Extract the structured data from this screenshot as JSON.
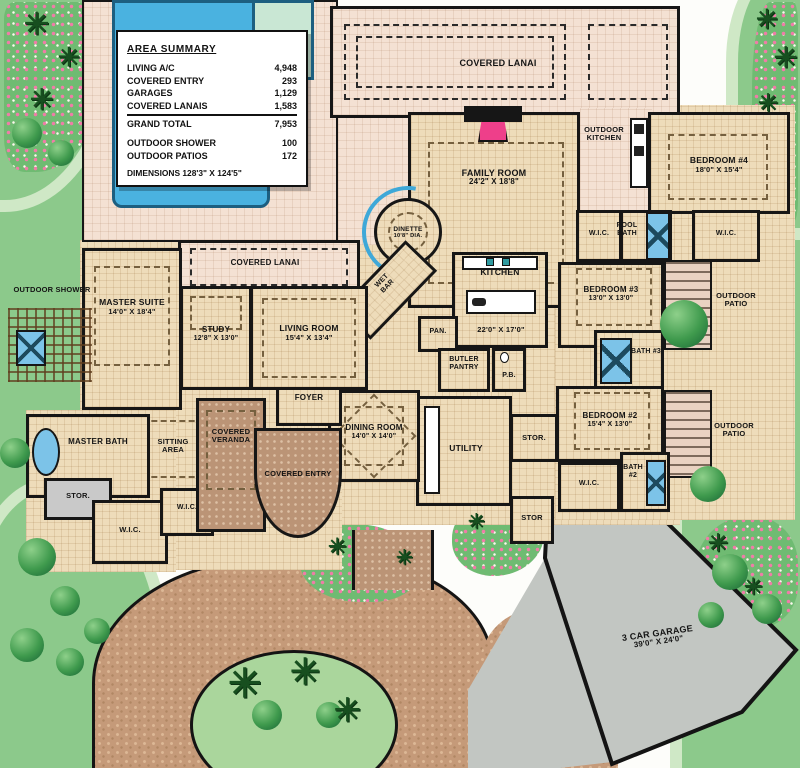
{
  "area_summary": {
    "title": "AREA SUMMARY",
    "rows": [
      {
        "label": "LIVING A/C",
        "value": "4,948"
      },
      {
        "label": "COVERED ENTRY",
        "value": "293"
      },
      {
        "label": "GARAGES",
        "value": "1,129"
      },
      {
        "label": "COVERED LANAIS",
        "value": "1,583"
      }
    ],
    "grand_total": {
      "label": "GRAND TOTAL",
      "value": "7,953"
    },
    "extras": [
      {
        "label": "OUTDOOR SHOWER",
        "value": "100"
      },
      {
        "label": "OUTDOOR PATIOS",
        "value": "172"
      }
    ],
    "dimensions": "DIMENSIONS 128'3\" X 124'5\""
  },
  "rooms": {
    "family_room": {
      "name": "FAMILY ROOM",
      "dims": "24'2\" X 18'8\""
    },
    "dinette": {
      "name": "DINETTE",
      "dims": "10'8\" DIA."
    },
    "kitchen": {
      "name": "KITCHEN",
      "dims": "22'0\" X 17'0\""
    },
    "living_room": {
      "name": "LIVING ROOM",
      "dims": "15'4\" X 13'4\""
    },
    "study": {
      "name": "STUDY",
      "dims": "12'8\" X 13'0\""
    },
    "master_suite": {
      "name": "MASTER SUITE",
      "dims": "14'0\" X 18'4\""
    },
    "dining_room": {
      "name": "DINING ROOM",
      "dims": "14'0\" X 14'0\""
    },
    "bedroom2": {
      "name": "BEDROOM #2",
      "dims": "15'4\" X 13'0\""
    },
    "bedroom3": {
      "name": "BEDROOM #3",
      "dims": "13'0\" X 13'0\""
    },
    "bedroom4": {
      "name": "BEDROOM #4",
      "dims": "18'0\" X 15'4\""
    },
    "garage": {
      "name": "3 CAR GARAGE",
      "dims": "39'0\" X 24'0\""
    }
  },
  "labels": {
    "inshelf": "INSHELF",
    "covered_lanai": "COVERED LANAI",
    "outdoor_kitchen": "OUTDOOR KITCHEN",
    "outdoor_shower": "OUTDOOR SHOWER",
    "outdoor_patio": "OUTDOOR PATIO",
    "covered_veranda": "COVERED VERANDA",
    "covered_entry": "COVERED ENTRY",
    "sitting_area": "SITTING AREA",
    "master_bath": "MASTER BATH",
    "wic": "W.I.C.",
    "stor": "STOR.",
    "stor_plain": "STOR",
    "pool_bath": "POOL BATH",
    "bath2": "BATH #2",
    "bath3": "BATH #3",
    "pan": "PAN.",
    "butler_pantry": "BUTLER PANTRY",
    "pb": "P.B.",
    "wet_bar": "WET BAR",
    "foyer": "FOYER",
    "utility": "UTILITY"
  },
  "icons": {
    "palm": "✳"
  },
  "colors": {
    "pool": "#4ab2e0",
    "sun_shelf": "#c9e7d4",
    "deck": "#f4e1d3",
    "interior": "#eedcba",
    "wall": "#161616",
    "grass": "#8cc98b",
    "shrub": "#2e8b42",
    "flower": "#f07ca8",
    "paver": "#bb9476",
    "driveway": "#c59a79",
    "garage_floor": "#c2c6c2",
    "fixture_blue": "#7cc3e8",
    "fireplace": "#ee3f8a"
  }
}
